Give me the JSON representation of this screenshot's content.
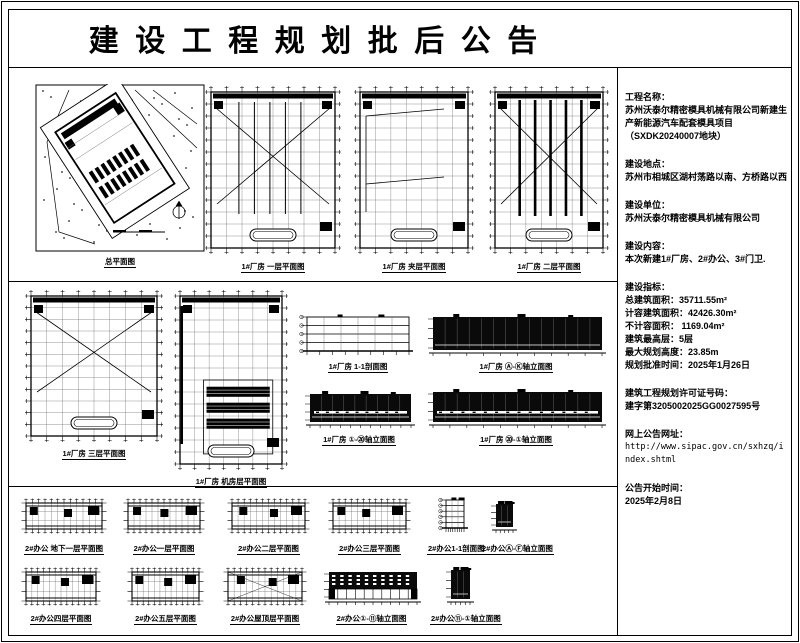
{
  "page": {
    "title": "建设工程规划批后公告",
    "ink_color": "#000000",
    "paper_color": "#ffffff"
  },
  "info": {
    "sections": [
      {
        "label": "工程名称：",
        "lines": [
          "苏州沃泰尔精密模具机械有限公司新建生",
          "产新能源汽车配套模具项目",
          "（SXDK20240007地块）"
        ]
      },
      {
        "label": "建设地点：",
        "lines": [
          "苏州市相城区湖村荡路以南、方桥路以西"
        ]
      },
      {
        "label": "建设单位：",
        "lines": [
          "苏州沃泰尔精密模具机械有限公司"
        ]
      },
      {
        "label": "建设内容：",
        "lines": [
          "本次新建1#厂房、2#办公、3#门卫."
        ]
      },
      {
        "label": "建设指标：",
        "lines": [
          "总建筑面积：35711.55m²",
          "计容建筑面积：42426.30m²",
          "不计容面积：  1169.04m²",
          "建筑最高层：5层",
          "最大规划高度：23.85m",
          "规划批准时间：2025年1月26日"
        ]
      },
      {
        "label": "建筑工程规划许可证号码：",
        "lines": [
          "建字第3205002025GG0027595号"
        ]
      },
      {
        "label": "网上公告网址：",
        "lines": [
          "http://www.sipac.gov.cn/sxhzq/index.shtml"
        ]
      },
      {
        "label": "公告开始时间：",
        "lines": [
          "2025年2月8日"
        ]
      }
    ]
  },
  "captions": {
    "site": "总平面图",
    "f1": "1#厂房 一层平面图",
    "fmezz": "1#厂房 夹层平面图",
    "f2": "1#厂房 二层平面图",
    "f3": "1#厂房 三层平面图",
    "fmech": "1#厂房 机房层平面图",
    "fsec": "1#厂房 1-1剖面图",
    "felev_a": "1#厂房 Ⓐ-Ⓚ轴立面图",
    "felev_1": "1#厂房 ①-⑳轴立面图",
    "felev_2": "1#厂房 ⑳-①轴立面图",
    "ob1": "2#办公 地下一层平面图",
    "o1": "2#办公一层平面图",
    "o2": "2#办公二层平面图",
    "o3": "2#办公三层平面图",
    "osec": "2#办公1-1剖面图",
    "oelev_a": "2#办公Ⓐ-Ⓕ轴立面图",
    "o4": "2#办公四层平面图",
    "o5": "2#办公五层平面图",
    "oroof": "2#办公屋顶层平面图",
    "oelev_1": "2#办公①-⑪轴立面图",
    "oelev_2": "2#办公⑪-①轴立面图"
  }
}
